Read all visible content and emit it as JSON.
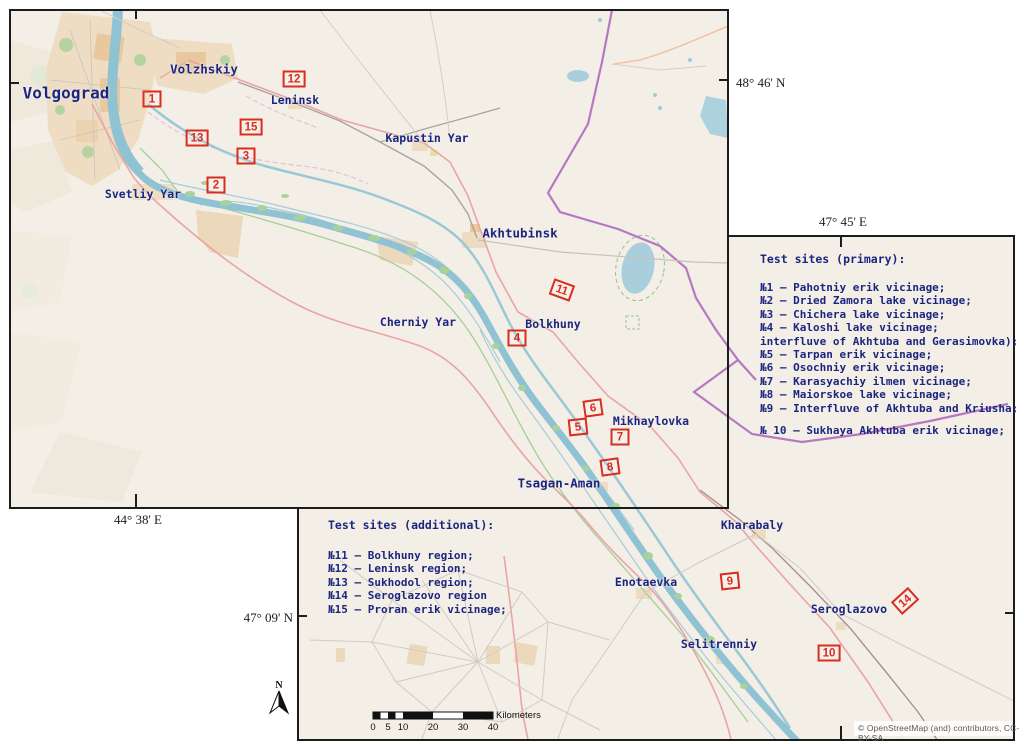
{
  "map": {
    "coordinates": {
      "ne_lat": "48° 46' N",
      "mid_lon": "47° 45' E",
      "sw_lon": "44° 38' E",
      "s_lat": "47° 09' N"
    },
    "cities": [
      {
        "label": "Volgograd"
      },
      {
        "label": "Volzhskiy"
      },
      {
        "label": "Leninsk"
      },
      {
        "label": "Kapustin Yar"
      },
      {
        "label": "Svetliy Yar"
      },
      {
        "label": "Akhtubinsk"
      },
      {
        "label": "Cherniy Yar"
      },
      {
        "label": "Bolkhuny"
      },
      {
        "label": "Mikhaylovka"
      },
      {
        "label": "Tsagan-Aman"
      },
      {
        "label": "Kharabaly"
      },
      {
        "label": "Enotaevka"
      },
      {
        "label": "Seroglazovo"
      },
      {
        "label": "Selitrenniy"
      }
    ],
    "markers": [
      {
        "num": "1"
      },
      {
        "num": "2"
      },
      {
        "num": "3"
      },
      {
        "num": "4"
      },
      {
        "num": "5"
      },
      {
        "num": "6"
      },
      {
        "num": "7"
      },
      {
        "num": "8"
      },
      {
        "num": "9"
      },
      {
        "num": "10"
      },
      {
        "num": "11"
      },
      {
        "num": "12"
      },
      {
        "num": "13"
      },
      {
        "num": "14"
      },
      {
        "num": "15"
      }
    ],
    "legend_primary": {
      "title": "Test sites (primary):",
      "items": [
        "№1 – Pahotniy erik vicinage;",
        "№2 – Dried Zamora lake vicinage;",
        "№3 – Chichera lake vicinage;",
        "№4 – Kaloshi lake vicinage;",
        "interfluve of Akhtuba and Gerasimovka);",
        "№5 – Tarpan erik vicinage;",
        "№6 – Osochniy erik vicinage;",
        "№7 – Karasyachiy ilmen vicinage;",
        "№8 – Maiorskoe lake vicinage;",
        "№9 – Interfluve of Akhtuba and Kriusha;",
        "№ 10 – Sukhaya Akhtuba erik vicinage;"
      ]
    },
    "legend_additional": {
      "title": "Test sites (additional):",
      "items": [
        "№11 – Bolkhuny region;",
        "№12 – Leninsk region;",
        "№13 – Sukhodol region;",
        "№14 – Seroglazovo region",
        "№15 – Proran erik vicinage;"
      ]
    },
    "scale_bar": {
      "ticks": [
        "0",
        "5",
        "10",
        "20",
        "30",
        "40"
      ],
      "unit": "Kilometers"
    },
    "north_label": "N",
    "attribution": "© OpenStreetMap (and) contributors, CC-BY-SA",
    "colors": {
      "marker_red": "#da2c20",
      "label_navy": "#1c2680",
      "water": "#8fc2d2",
      "admin_purple": "#b678c0",
      "map_background": "#f3efe7"
    }
  }
}
